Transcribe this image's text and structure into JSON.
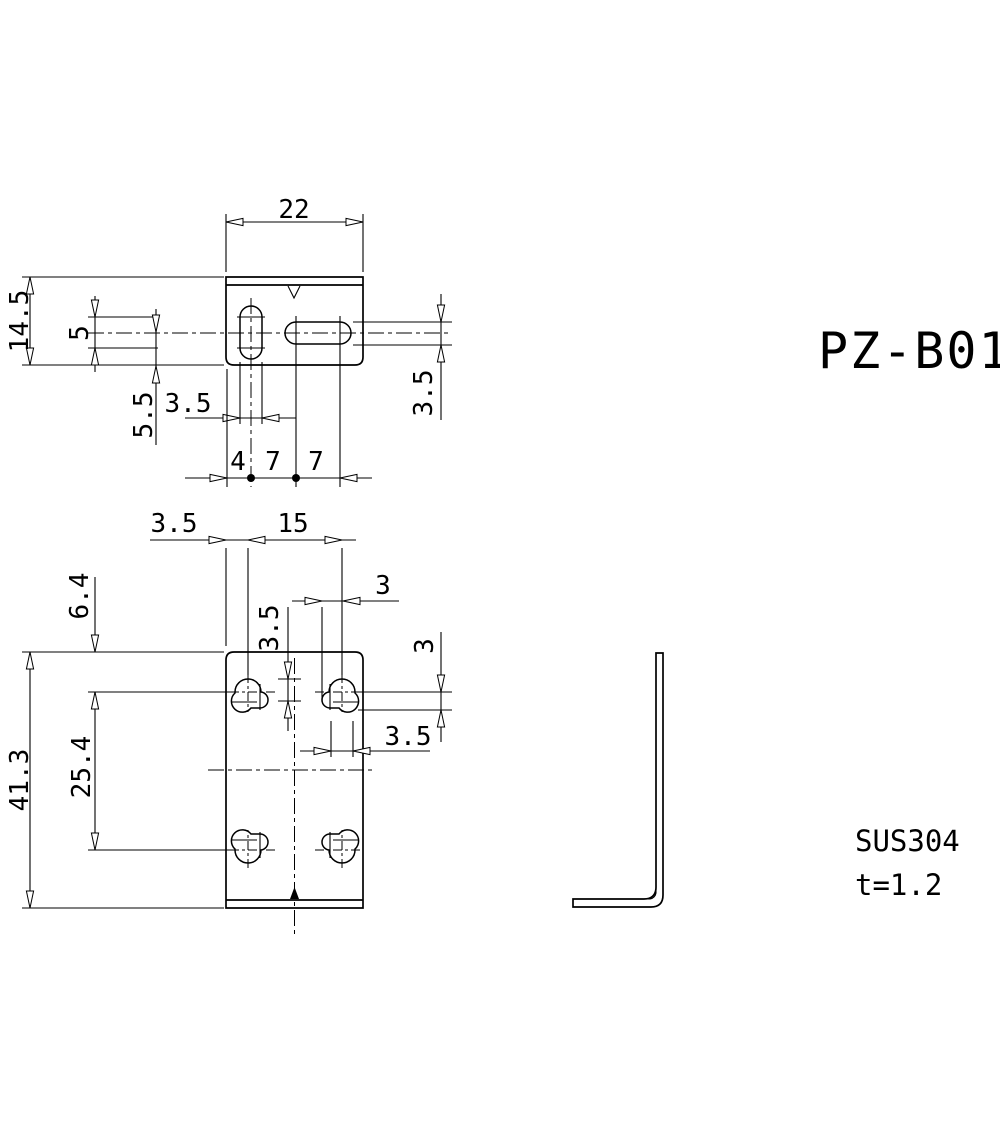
{
  "title": "PZ-B01",
  "material": "SUS304",
  "thickness": "t=1.2",
  "colors": {
    "line": "#000000",
    "background": "#ffffff"
  },
  "top_view": {
    "width": "22",
    "depth": "14.5",
    "slot_length": "5",
    "slot_center_offset": "5.5",
    "slot_width": "3.5",
    "pitch_left": "4",
    "pitch_mid": "7",
    "pitch_right": "7",
    "hslot_width": "3.5"
  },
  "front_view": {
    "edge_to_hole": "3.5",
    "hole_pitch": "15",
    "notch_x": "3",
    "lobe_h": "3.5",
    "notch_y": "3",
    "lobe_w": "3.5",
    "top_to_row": "6.4",
    "row_pitch": "25.4",
    "height": "41.3"
  }
}
